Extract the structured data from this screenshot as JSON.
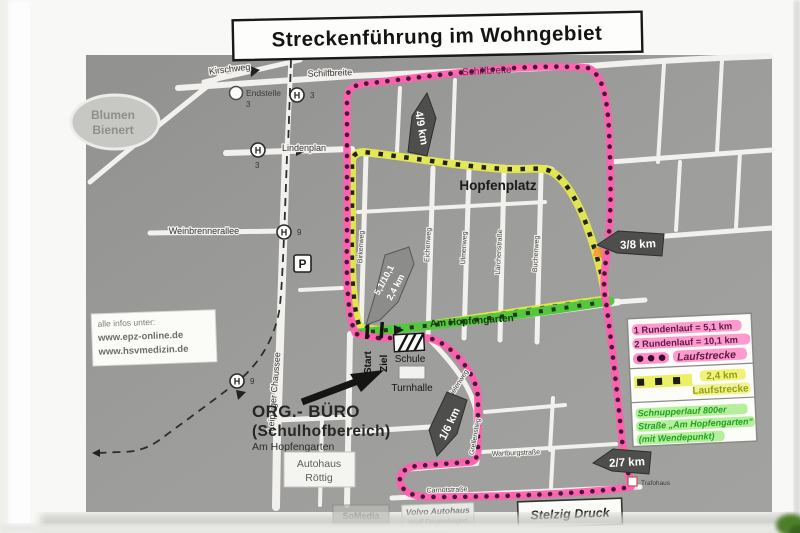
{
  "title": "Streckenführung im Wohngebiet",
  "info_box": {
    "intro": "alle infos unter:",
    "url1": "www.epz-online.de",
    "url2": "www.hsvmedizin.de"
  },
  "legend": {
    "round1": "1 Rundenlauf = 5,1 km",
    "round2": "2 Rundenlauf = 10,1 km",
    "main_label": "Laufstrecke",
    "short_distance": "2,4 km",
    "short_label": "Laufstrecke",
    "schnupper1": "Schnupperlauf 800er",
    "schnupper2": "Straße „Am Hopfengarten“",
    "schnupper3": "(mit Wendepunkt)"
  },
  "markers": {
    "km49": "4/9 km",
    "km38": "3/8 km",
    "km16": "1/6 km",
    "km27": "2/7 km",
    "mid1": "5,1/10,1",
    "mid2": "2,4 km"
  },
  "streets": {
    "kirschweg": "Kirschweg",
    "schilfbreite_west": "Schilfbreite",
    "schilfbreite_east": "Schilfbreite",
    "lindenplan": "Lindenplan",
    "weinbrennerallee": "Weinbrennerallee",
    "leipziger_chaussee": "Leipziger Chaussee",
    "birkenweg": "Birkenweg",
    "eichenweg": "Eichenweg",
    "ulmenweg": "Ulmenweg",
    "laerchenstrasse": "Lärchenstraße",
    "buchenweg": "Buchenweg",
    "am_hopfengarten": "Am Hopfengarten",
    "hopfenplatz": "Hopfenplatz",
    "carnotstrasse": "Carnotstraße",
    "grellenstieg": "Grellenstieg",
    "bielenweg": "Bielenweg",
    "wartburgstrasse": "Wartburgstraße",
    "salzastrasse": "Salzastraße"
  },
  "places": {
    "blumen1": "Blumen",
    "blumen2": "Bienert",
    "start": "Start",
    "ziel": "Ziel",
    "schule": "Schule",
    "turnhalle": "Turnhalle",
    "org1": "ORG.- BÜRO",
    "org2": "(Schulhofbereich)",
    "org3": "Am Hopfengarten",
    "autohaus1": "Autohaus",
    "autohaus2": "Röttig",
    "volvo1": "Volvo Autohaus",
    "volvo2": "Wolf Degenhagen",
    "somedia": "SoMedia",
    "stelzig": "Stelzig Druck",
    "trafohaus": "Trafohaus"
  },
  "transit": {
    "stop": "H",
    "line3": "3",
    "line9": "9",
    "endstelle": "Endstelle",
    "endstelle_line": "3",
    "parking": "P"
  },
  "colors": {
    "route_main": "#ff5fb0",
    "route_main_dots": "#471a33",
    "route_short": "#e3e84c",
    "route_short_marks": "#222222",
    "route_schnupper": "#54c73e",
    "marker_bg": "#4e4e4e",
    "map_bg": "#9b9b9b"
  }
}
